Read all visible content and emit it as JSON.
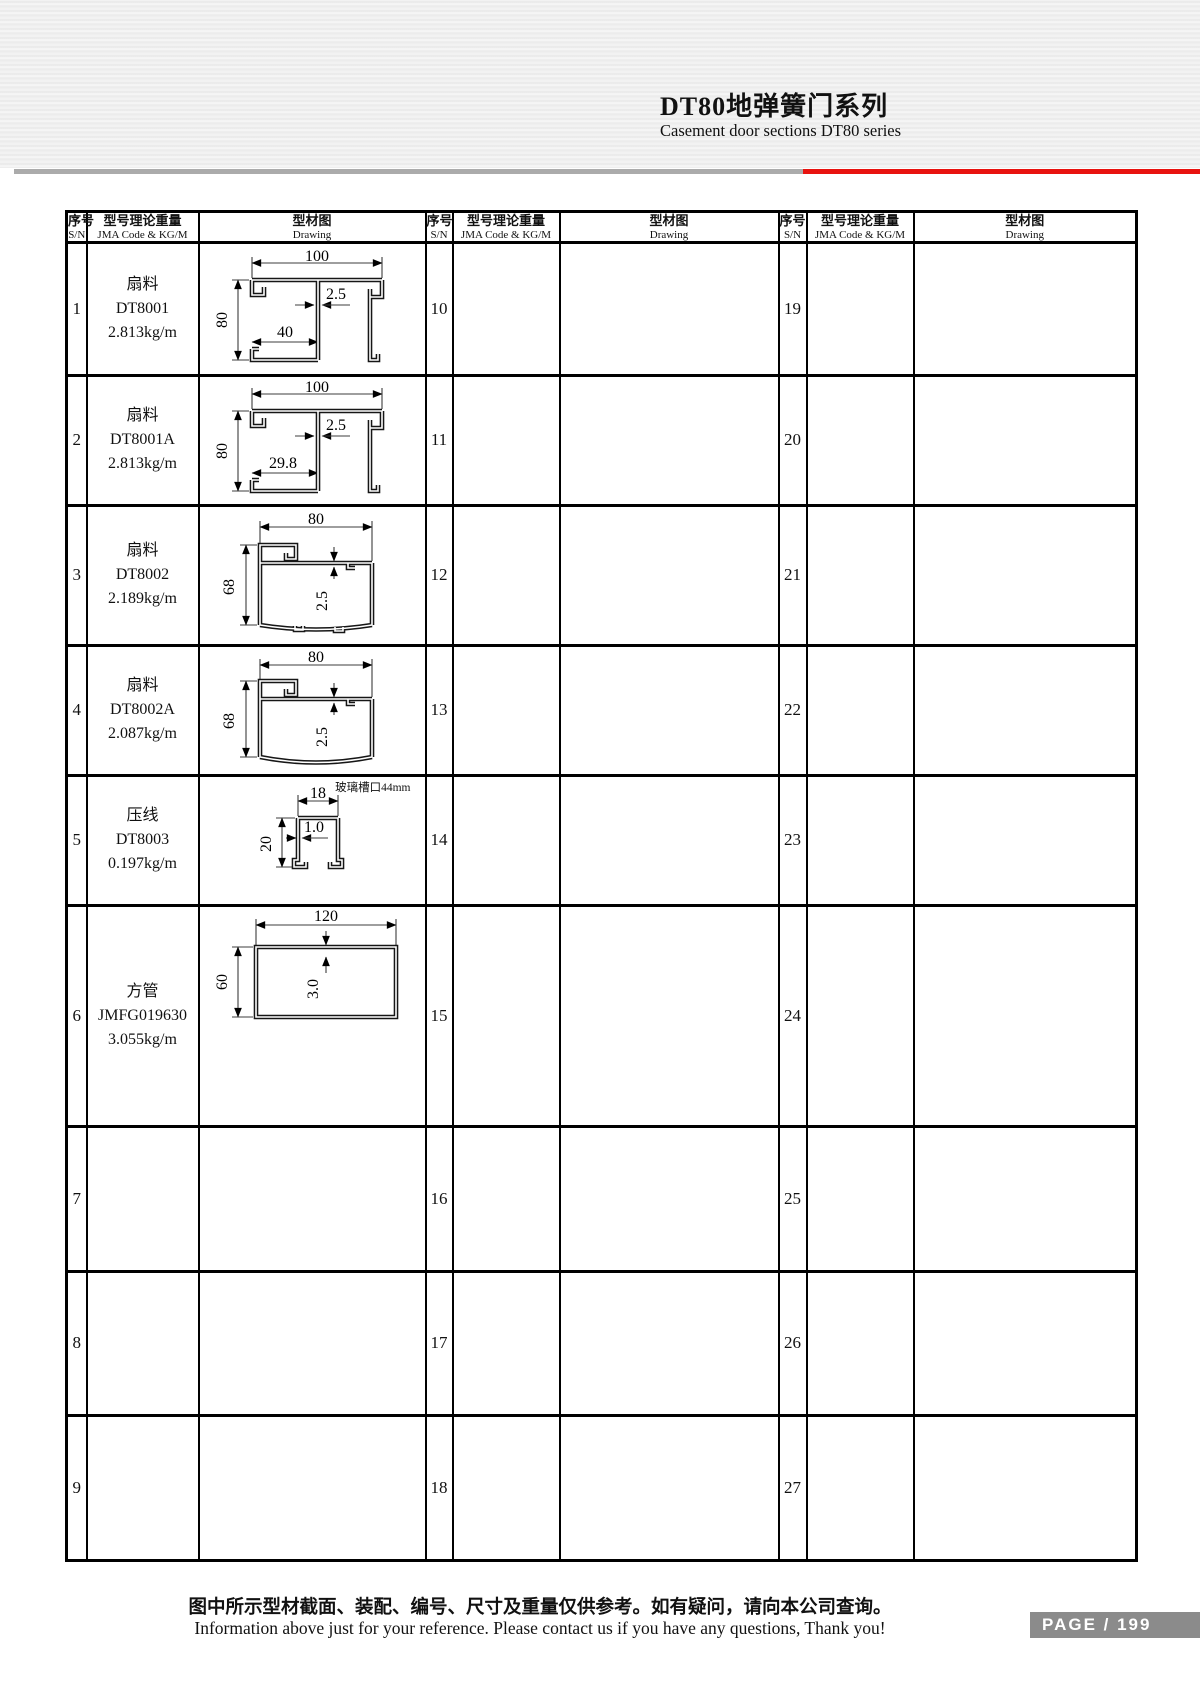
{
  "page": {
    "title": "DT80地弹簧门系列",
    "subtitle": "Casement door sections DT80 series",
    "footer_note_cn": "图中所示型材截面、装配、编号、尺寸及重量仅供参考。如有疑问，请向本公司查询。",
    "footer_note_en": "Information above just for your reference. Please contact us if you have any questions, Thank you!",
    "page_label": "PAGE / 199",
    "colors": {
      "accent_red": "#e8130f",
      "rule_gray": "#ababab",
      "badge_gray": "#8b8b8b"
    }
  },
  "table": {
    "header": {
      "sn_cn": "序号",
      "sn_en": "S/N",
      "code_cn": "型号理论重量",
      "code_en": "JMA Code & KG/M",
      "drawing_cn": "型材图",
      "drawing_en": "Drawing"
    },
    "group1": [
      {
        "sn": "1",
        "name": "扇料",
        "code": "DT8001",
        "weight": "2.813kg/m"
      },
      {
        "sn": "2",
        "name": "扇料",
        "code": "DT8001A",
        "weight": "2.813kg/m"
      },
      {
        "sn": "3",
        "name": "扇料",
        "code": "DT8002",
        "weight": "2.189kg/m"
      },
      {
        "sn": "4",
        "name": "扇料",
        "code": "DT8002A",
        "weight": "2.087kg/m"
      },
      {
        "sn": "5",
        "name": "压线",
        "code": "DT8003",
        "weight": "0.197kg/m"
      },
      {
        "sn": "6",
        "name": "方管",
        "code": "JMFG019630",
        "weight": "3.055kg/m"
      },
      {
        "sn": "7"
      },
      {
        "sn": "8"
      },
      {
        "sn": "9"
      }
    ],
    "group2": [
      {
        "sn": "10"
      },
      {
        "sn": "11"
      },
      {
        "sn": "12"
      },
      {
        "sn": "13"
      },
      {
        "sn": "14"
      },
      {
        "sn": "15"
      },
      {
        "sn": "16"
      },
      {
        "sn": "17"
      },
      {
        "sn": "18"
      }
    ],
    "group3": [
      {
        "sn": "19"
      },
      {
        "sn": "20"
      },
      {
        "sn": "21"
      },
      {
        "sn": "22"
      },
      {
        "sn": "23"
      },
      {
        "sn": "24"
      },
      {
        "sn": "25"
      },
      {
        "sn": "26"
      },
      {
        "sn": "27"
      }
    ]
  },
  "drawings": {
    "dt8001": {
      "dim_width": "100",
      "dim_height": "80",
      "dim_thickness": "2.5",
      "dim_inner": "40"
    },
    "dt8001a": {
      "dim_width": "100",
      "dim_height": "80",
      "dim_thickness": "2.5",
      "dim_inner": "29.8"
    },
    "dt8002": {
      "dim_width": "80",
      "dim_height": "68",
      "dim_thickness": "2.5"
    },
    "dt8002a": {
      "dim_width": "80",
      "dim_height": "68",
      "dim_thickness": "2.5"
    },
    "dt8003": {
      "dim_width": "18",
      "dim_height": "20",
      "dim_thickness": "1.0",
      "note": "玻璃槽口44mm"
    },
    "jmfg019630": {
      "dim_width": "120",
      "dim_height": "60",
      "dim_thickness": "3.0"
    }
  }
}
